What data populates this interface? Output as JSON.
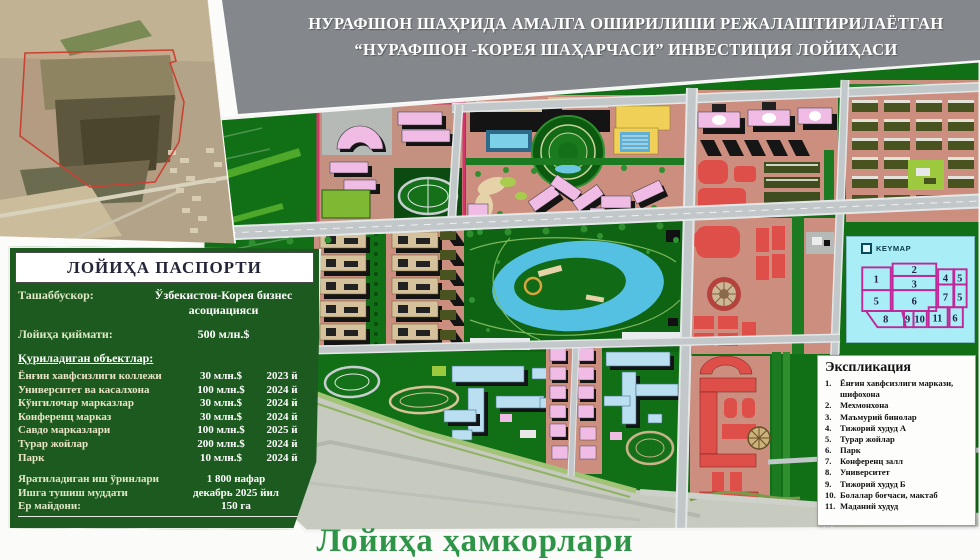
{
  "title": {
    "line1": "НУРАФШОН ШАҲРИДА АМАЛГА ОШИРИЛИШИ РЕЖАЛАШТИРИЛАЁТГАН",
    "line2": "“НУРАФШОН -КОРЕЯ ШАҲАРЧАСИ” ИНВЕСТИЦИЯ ЛОЙИҲАСИ"
  },
  "passport": {
    "header": "ЛОЙИҲА ПАСПОРТИ",
    "initiator_label": "Ташаббускор:",
    "initiator_value": "Ўзбекистон-Корея бизнес асоциацияси",
    "cost_label": "Лойиҳа қиймати:",
    "cost_value": "500 млн.$",
    "objects_label": "Қуриладиган объектлар:",
    "objects": [
      {
        "name": "Ёнғин хавфсизлиги коллежи",
        "cost": "30 млн.$",
        "year": "2023 й"
      },
      {
        "name": "Университет ва касалхона",
        "cost": "100 млн.$",
        "year": "2024 й"
      },
      {
        "name": "Кўнгилочар марказлар",
        "cost": "30 млн.$",
        "year": "2024 й"
      },
      {
        "name": "Конференц марказ",
        "cost": "30 млн.$",
        "year": "2024 й"
      },
      {
        "name": "Савдо марказлари",
        "cost": "100 млн.$",
        "year": "2025 й"
      },
      {
        "name": "Турар жойлар",
        "cost": "200 млн.$",
        "year": "2024 й"
      },
      {
        "name": "Парк",
        "cost": "10 млн.$",
        "year": "2024 й"
      }
    ],
    "footer": [
      {
        "label": "Яратиладиган иш ўринлари",
        "value": "1 800 нафар"
      },
      {
        "label": "Ишга тушиш муддати",
        "value": "декабрь 2025 йил"
      },
      {
        "label": "Ер майдони:",
        "value": "150 га"
      }
    ]
  },
  "legend": {
    "title": "Экспликация",
    "items": [
      {
        "n": "1.",
        "t": "Ёнғин хавфсизлиги маркази, шифохона"
      },
      {
        "n": "2.",
        "t": "Мехмонхона"
      },
      {
        "n": "3.",
        "t": "Маъмурий бинолар"
      },
      {
        "n": "4.",
        "t": "Тижорий худуд А"
      },
      {
        "n": "5.",
        "t": "Турар жойлар"
      },
      {
        "n": "6.",
        "t": "Парк"
      },
      {
        "n": "7.",
        "t": "Конференц залл"
      },
      {
        "n": "8.",
        "t": "Университет"
      },
      {
        "n": "9.",
        "t": "Тижорий худуд Б"
      },
      {
        "n": "10.",
        "t": "Болалар боғчаси, мактаб"
      },
      {
        "n": "11.",
        "t": "Маданий худуд"
      }
    ]
  },
  "keymap": {
    "label": "KEYMAP",
    "zones": [
      "1",
      "2",
      "3",
      "4",
      "5",
      "5",
      "6",
      "7",
      "5",
      "8",
      "9",
      "10",
      "11",
      "6"
    ]
  },
  "footer_title": "Лойиҳа ҳамкорлари",
  "colors": {
    "band_gray": "#84888c",
    "panel_green": "#1d5a1f",
    "footer_green": "#2e9447",
    "map_green": "#117016",
    "block_salmon": "#cc8e7e",
    "building_pink": "#f0bce6",
    "building_red": "#df4f4a",
    "water_blue": "#54c0e2",
    "keymap_cyan": "#a9edf6",
    "outline_crimson": "#d6356b",
    "site_outline_red": "#c94233"
  }
}
